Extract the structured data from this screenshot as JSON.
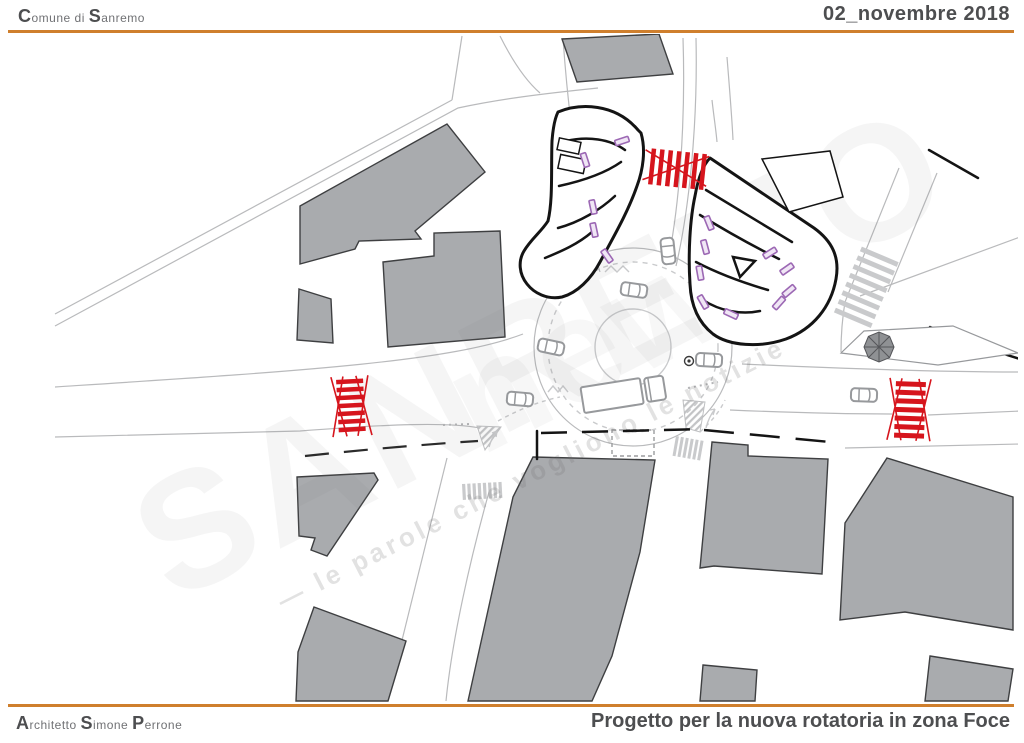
{
  "header": {
    "municipality": {
      "initial1": "C",
      "part1": "omune di ",
      "initial2": "S",
      "part2": "anremo"
    },
    "date": "02_novembre 2018"
  },
  "footer": {
    "architect": {
      "initial1": "A",
      "part1": "rchitetto ",
      "initial2": "S",
      "part2": "imone ",
      "initial3": "P",
      "part3": "errone"
    },
    "project_title": "Progetto per la nuova rotatoria in zona Foce"
  },
  "watermark": {
    "brand_primary": "SANREMO",
    "brand_secondary": "news",
    "tagline": "— le parole che vogliono le notizie"
  },
  "colors": {
    "accent_orange": "#cf7f2d",
    "title_text": "#4d4e50",
    "subtle_text": "#707174",
    "building_fill": "#a9abae",
    "building_stroke": "#3e3f41",
    "design_black": "#141414",
    "crosswalk_red": "#d6151d",
    "parking_purple": "#9c68b4",
    "road_line": "#b9babc",
    "marking_light": "#c9cacc",
    "vehicle_gray": "#97999c"
  }
}
